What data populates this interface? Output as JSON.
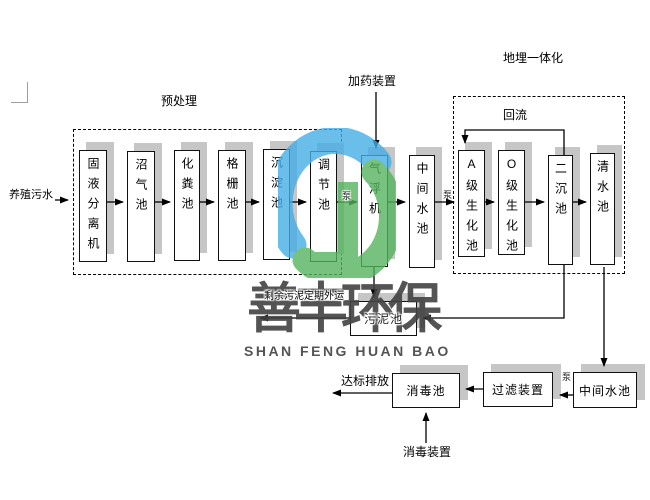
{
  "labels": {
    "pretreatment_group": "预处理",
    "buried_group": "地埋一体化",
    "influent": "养殖污水",
    "dosing_device": "加药装置",
    "reflux": "回流",
    "pump": "泵",
    "sludge_out": "剩余污泥定期外运",
    "discharge": "达标排放",
    "disinfect_device": "消毒装置"
  },
  "flow": {
    "process_boxes": [
      {
        "id": "solid-liquid-separator",
        "label": "固液分离机"
      },
      {
        "id": "biogas-pool",
        "label": "沼气池"
      },
      {
        "id": "septic-tank",
        "label": "化粪池"
      },
      {
        "id": "grid-pool",
        "label": "格栅池"
      },
      {
        "id": "sedimentation-pool",
        "label": "沉淀池"
      },
      {
        "id": "regulation-pool",
        "label": "调节池"
      },
      {
        "id": "air-flotation-machine",
        "label": "气浮机"
      },
      {
        "id": "intermediate-pool-1",
        "label": "中间水池"
      },
      {
        "id": "a-level-bio-pool",
        "label": "A级生化池"
      },
      {
        "id": "o-level-bio-pool",
        "label": "O级生化池"
      },
      {
        "id": "secondary-sedimentation-pool",
        "label": "二沉池"
      },
      {
        "id": "clear-water-pool",
        "label": "清水池"
      }
    ],
    "bottom_boxes": [
      {
        "id": "sludge-pool",
        "label": "污泥池"
      },
      {
        "id": "disinfection-pool",
        "label": "消毒池"
      },
      {
        "id": "filter-device",
        "label": "过滤装置"
      },
      {
        "id": "intermediate-pool-2",
        "label": "中间水池"
      }
    ]
  },
  "watermark": {
    "cn": "善丰环保",
    "en": "SHAN FENG HUAN BAO"
  },
  "colors": {
    "logo_blue": "#46aee6",
    "logo_green": "#54b45e",
    "box_shadow": "#c6c6c6",
    "watermark_text": "#424242"
  }
}
